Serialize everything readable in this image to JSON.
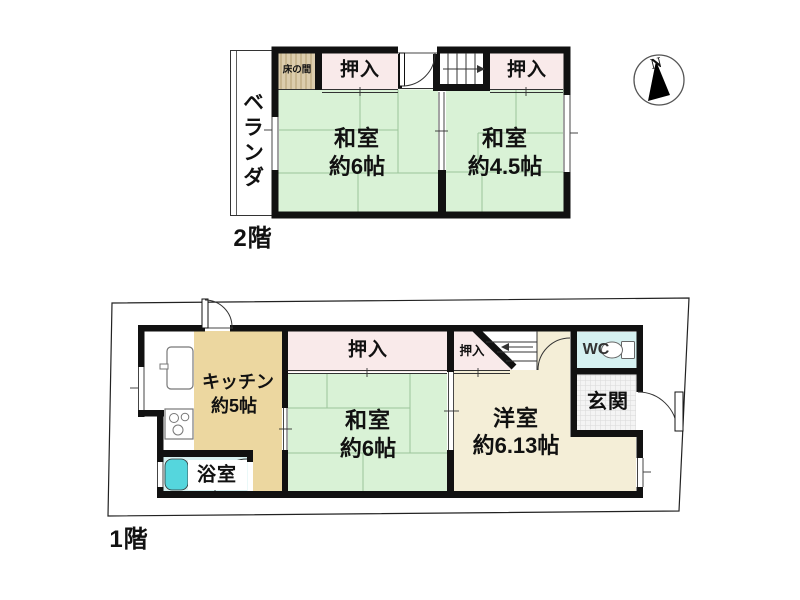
{
  "floor2": {
    "floor_label": "2階",
    "veranda": "ベランダ",
    "tokonoma": "床の間",
    "closet_left": "押入",
    "closet_right": "押入",
    "washitsu6": {
      "name": "和室",
      "size": "約6帖"
    },
    "washitsu45": {
      "name": "和室",
      "size": "約4.5帖"
    }
  },
  "floor1": {
    "floor_label": "1階",
    "kitchen": {
      "name": "キッチン",
      "size": "約5帖"
    },
    "closet": "押入",
    "closet_small": "押入",
    "washitsu6": {
      "name": "和室",
      "size": "約6帖"
    },
    "youshitsu": {
      "name": "洋室",
      "size": "約6.13帖"
    },
    "wc": "WC",
    "genkan": "玄関",
    "bathroom": "浴室"
  },
  "compass": {
    "north_label": "N"
  },
  "colors": {
    "tatami": "#d9f2d6",
    "tatami_line": "#9cc49a",
    "closet": "#f9eaea",
    "kitchen": "#ecd7a0",
    "western_room": "#f4eed7",
    "wet_area": "#d6f1f1",
    "bathtub": "#55d6dd",
    "tokonoma": "#dccdad",
    "wall": "#111111"
  }
}
